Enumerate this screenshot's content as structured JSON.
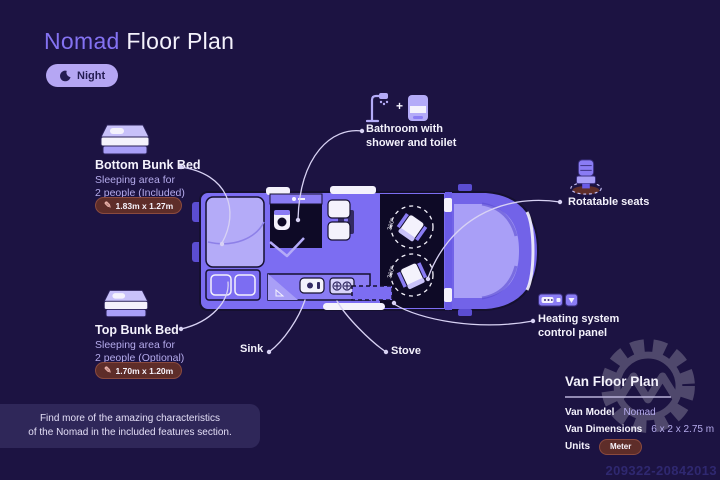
{
  "header": {
    "brand": "Nomad",
    "title_rest": " Floor Plan",
    "mode_label": "Night"
  },
  "bottom_bunk": {
    "title": "Bottom Bunk Bed",
    "desc1": "Sleeping area for",
    "desc2": "2 people (Included)",
    "dim": "1.83m x 1.27m",
    "dim_icon": "✎"
  },
  "top_bunk": {
    "title": "Top Bunk Bed",
    "desc1": "Sleeping area for",
    "desc2": "2 people (Optional)",
    "dim": "1.70m x 1.20m",
    "dim_icon": "✎"
  },
  "callouts": {
    "bathroom1": "Bathroom with",
    "bathroom2": "shower and toilet",
    "bathroom_plus": "+",
    "seats": "Rotatable seats",
    "heating1": "Heating system",
    "heating2": "control panel",
    "sink": "Sink",
    "stove": "Stove"
  },
  "van": {
    "rotation_label": "360°"
  },
  "info_panel": {
    "title": "Van Floor Plan",
    "rows": [
      {
        "label": "Van Model",
        "value": "Nomad"
      },
      {
        "label": "Van Dimensions",
        "value": "6 x 2 x 2.75 m"
      },
      {
        "label": "Units",
        "value": "Meter"
      }
    ]
  },
  "note": {
    "line1": "Find more of the amazing characteristics",
    "line2": "of the Nomad in the included features section."
  },
  "watermark": {
    "id": "209322-20842013"
  },
  "colors": {
    "background": "#1c1342",
    "accent_purple": "#8472f2",
    "van_purple": "#7c6df2",
    "badge_maroon": "#5e2d29",
    "pill_lavender": "#b5a6f3",
    "text_light": "#b5abec"
  }
}
